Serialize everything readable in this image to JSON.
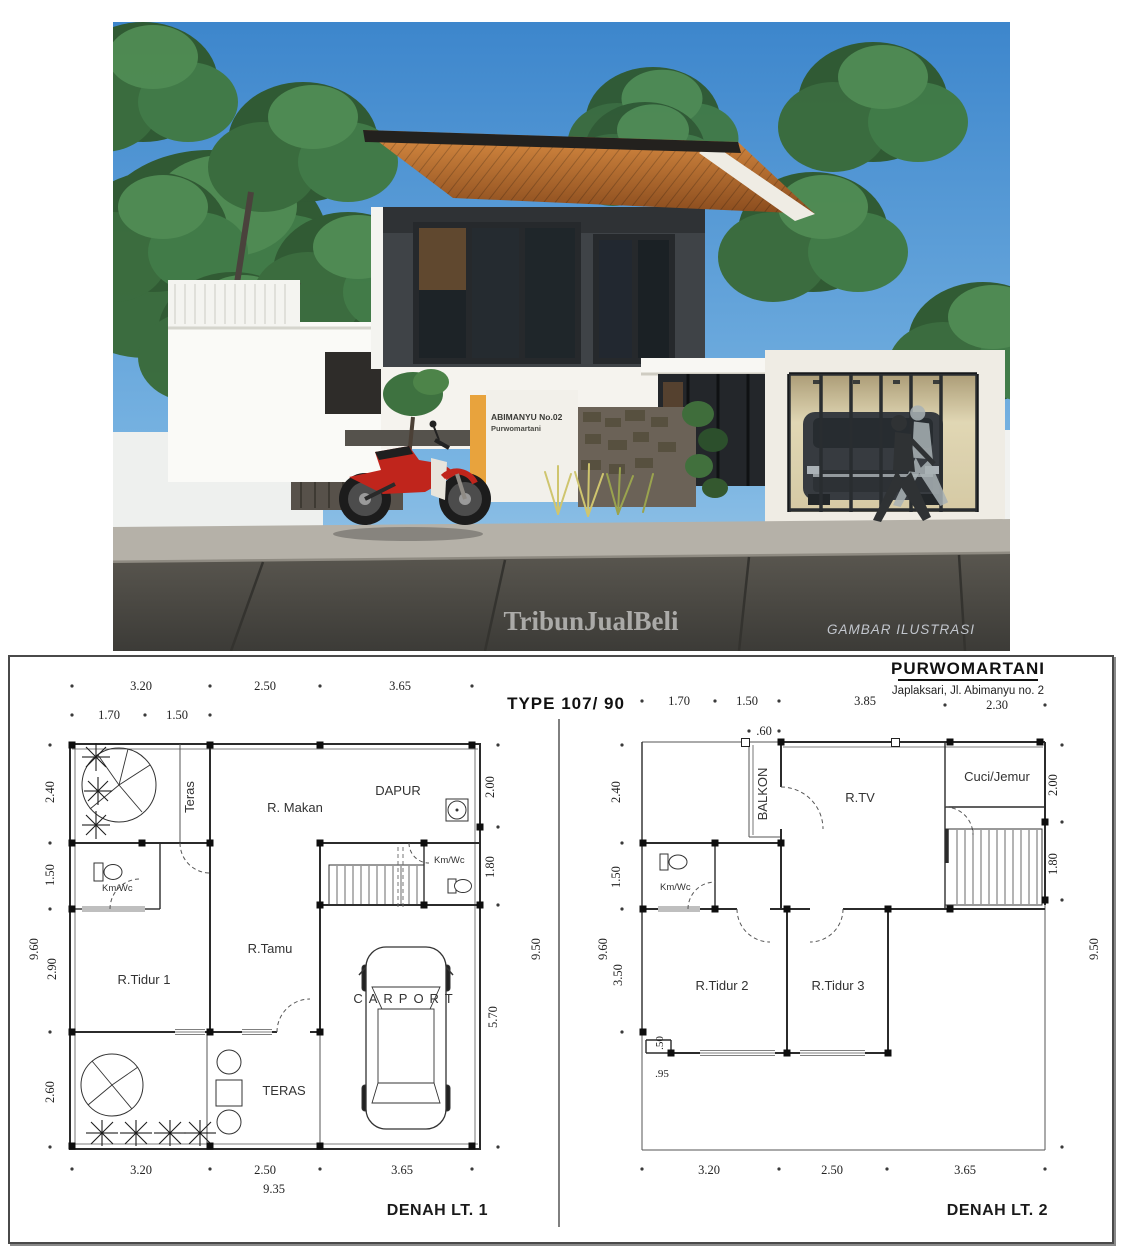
{
  "header": {
    "title": "PURWOMARTANI",
    "subtitle": "Japlaksari, Jl. Abimanyu no. 2",
    "type_label": "TYPE 107/ 90"
  },
  "photo": {
    "watermark": "TribunJualBeli",
    "caption": "GAMBAR ILUSTRASI",
    "sign_line1": "ABIMANYU No.02",
    "sign_line2": "Purwomartani",
    "colors": {
      "sky": "#4a8fd0",
      "roof_soffit": "#c97a33",
      "accent_post": "#e8a33d",
      "motorbike": "#c0251c"
    }
  },
  "plan1": {
    "title": "DENAH LT. 1",
    "dims_top": [
      "3.20",
      "2.50",
      "3.65"
    ],
    "dims_top2": [
      "1.70",
      "1.50"
    ],
    "dims_left": [
      "2.40",
      "1.50",
      "2.90",
      "2.60"
    ],
    "dims_left_total": "9.60",
    "dims_right": [
      "2.00",
      "1.80",
      "5.70"
    ],
    "dims_right_total": "9.50",
    "dims_bottom": [
      "3.20",
      "2.50",
      "3.65"
    ],
    "dims_bottom_total": "9.35",
    "rooms": {
      "teras_side": "Teras",
      "r_makan": "R. Makan",
      "dapur": "DAPUR",
      "kmwc1": "Km/Wc",
      "kmwc2": "Km/Wc",
      "tidur1": "R.Tidur 1",
      "tamu": "R.Tamu",
      "carport": "CARPORT",
      "teras_front": "TERAS"
    }
  },
  "plan2": {
    "title": "DENAH LT. 2",
    "dims_top": [
      "1.70",
      "1.50",
      "3.85",
      "2.30"
    ],
    "dims_top2": [
      ".60"
    ],
    "dims_left": [
      "2.40",
      "1.50",
      "3.50"
    ],
    "dims_left_total": "9.60",
    "dims_right": [
      "2.00",
      "1.80"
    ],
    "dims_right_total": "9.50",
    "dims_inner": [
      ".50",
      ".95"
    ],
    "dims_bottom": [
      "3.20",
      "2.50",
      "3.65"
    ],
    "rooms": {
      "balkon": "BALKON",
      "rtv": "R.TV",
      "cuci": "Cuci/Jemur",
      "kmwc": "Km/Wc",
      "tidur2": "R.Tidur 2",
      "tidur3": "R.Tidur 3"
    }
  }
}
